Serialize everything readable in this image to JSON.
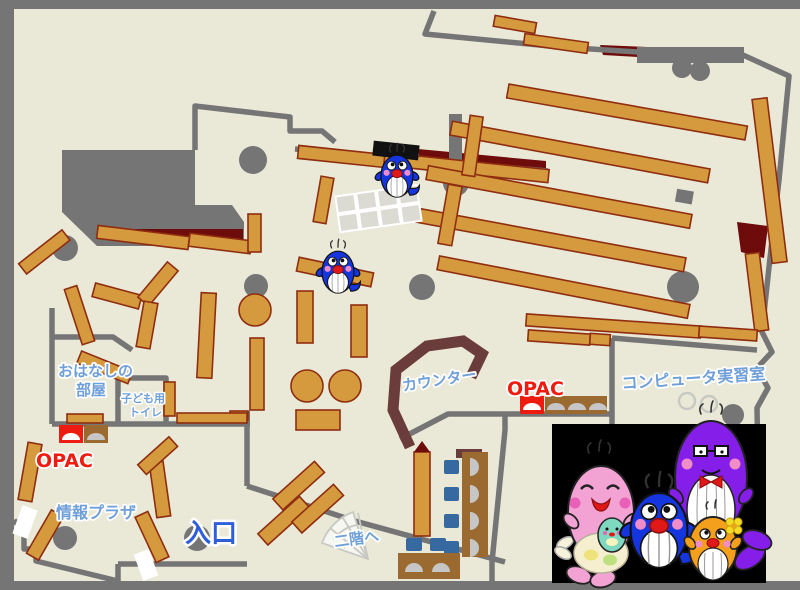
{
  "labels": {
    "ohanashi1": "おはなしの",
    "ohanashi2": "部屋",
    "toilet1": "子ども用",
    "toilet2": "トイレ",
    "opac_left": "OPAC",
    "opac_right": "OPAC",
    "joho_plaza": "情報プラザ",
    "entrance": "入口",
    "stairs": "二階へ",
    "counter": "カウンター",
    "computer_room": "コンピュータ実習室"
  },
  "palette": {
    "floor": "#eae9d8",
    "wall": "#757575",
    "shelf": "#d59a3d",
    "shelf-border": "#8f2d10",
    "maroon": "#6e0b0b",
    "counter": "#6b3c3c",
    "desk": "#9a6a30",
    "chair": "#3569a0",
    "monitor": "#c6c6c6",
    "grid": "#dbdad3",
    "stairs-line": "#c9c9c3",
    "label-blue": "#6f9fd8",
    "entrance-blue": "#2e5ed9",
    "opac-red": "#ee1b10",
    "whale-blue": "#1535de",
    "whale-pink": "#f2a3d4",
    "whale-purple": "#841ee8",
    "whale-orange": "#f5a01c",
    "whale-teal": "#7fd8c0",
    "cheek": "#f08cc8",
    "mouth-red": "#e01818",
    "photo-bg": "#000000"
  }
}
